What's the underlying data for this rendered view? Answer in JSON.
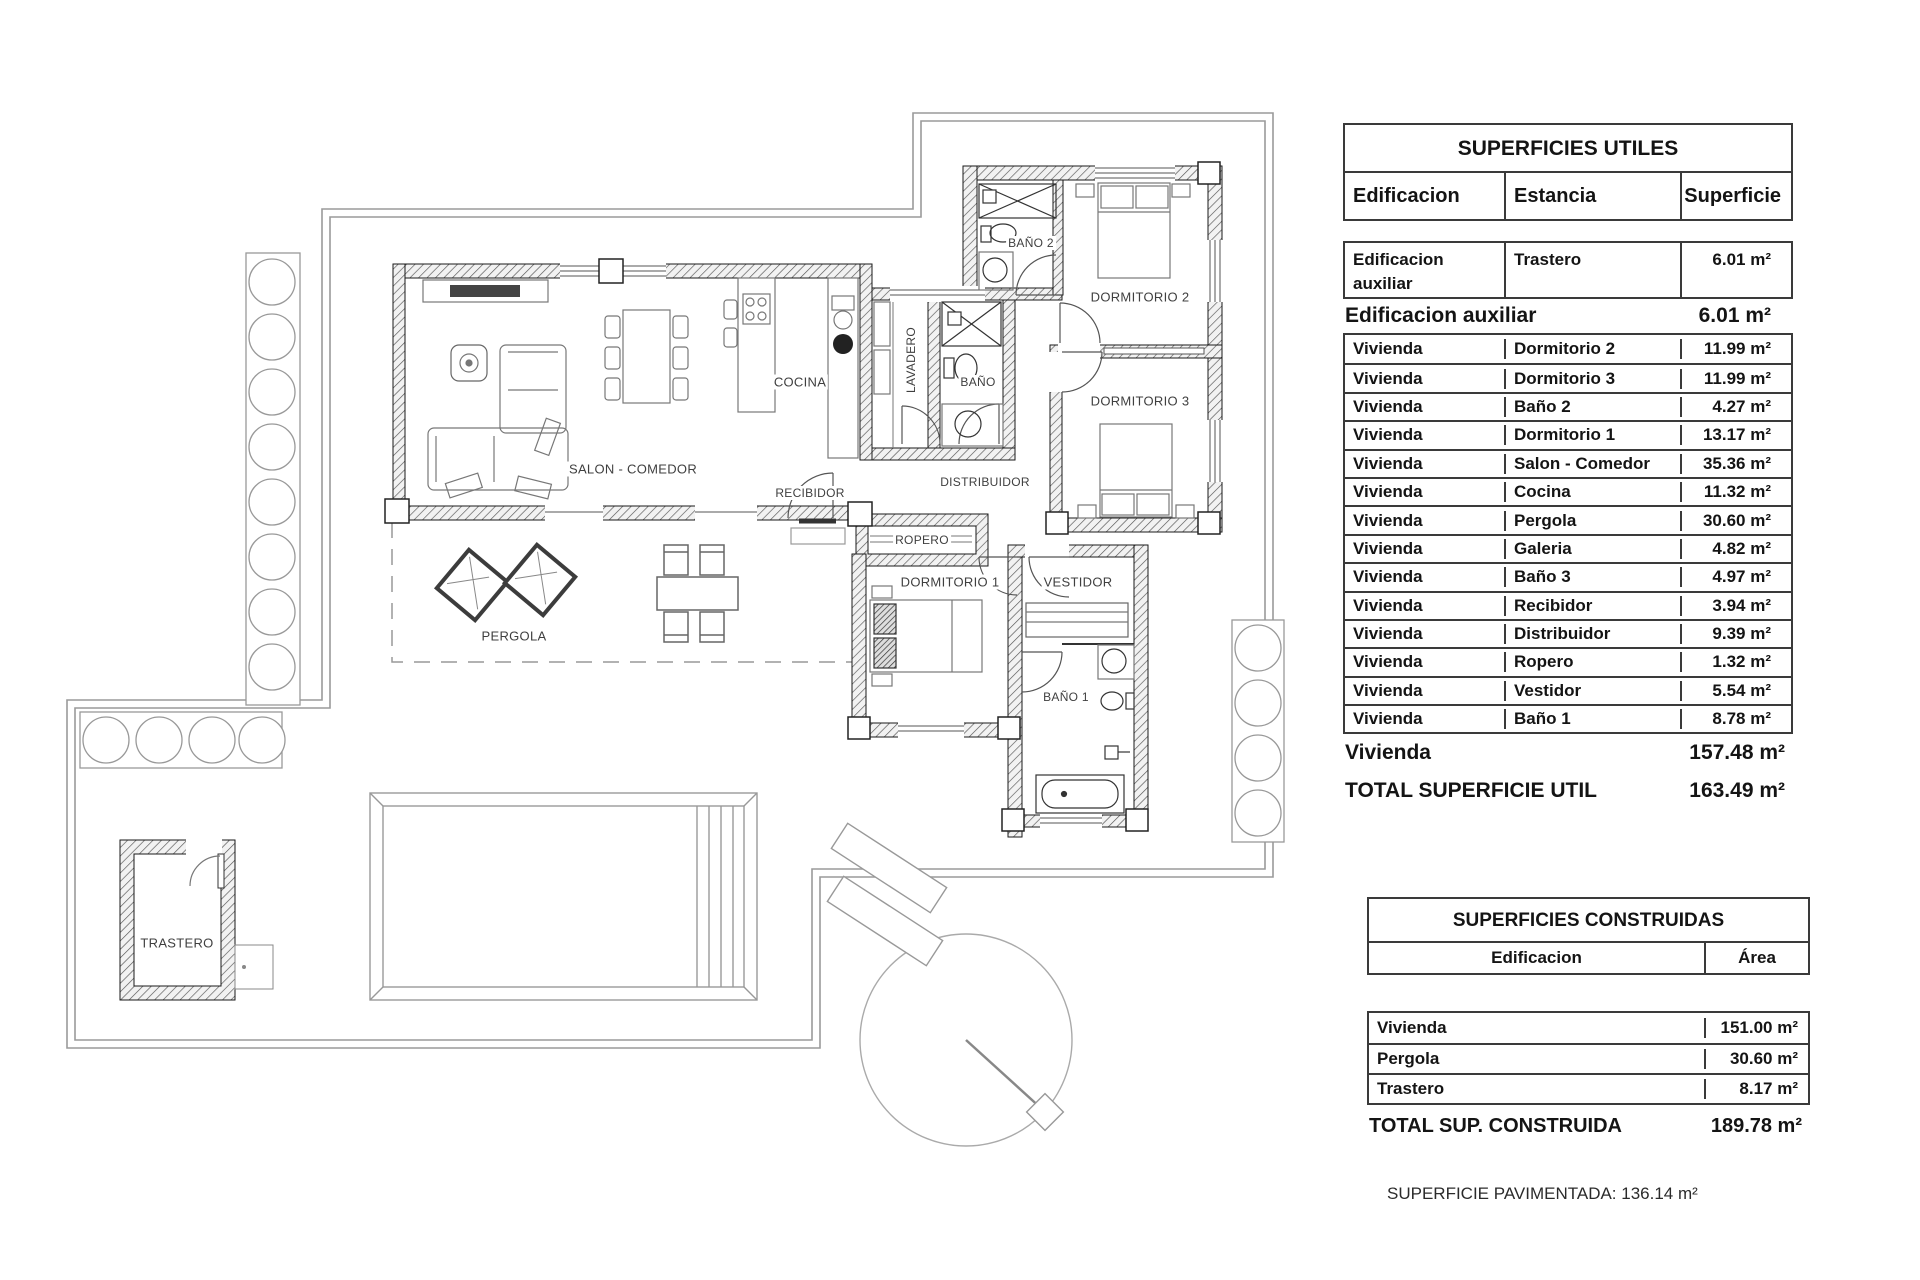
{
  "floorplan": {
    "rooms": [
      {
        "label": "BAÑO 2"
      },
      {
        "label": "DORMITORIO 2"
      },
      {
        "label": "LAVADERO"
      },
      {
        "label": "BAÑO"
      },
      {
        "label": "COCINA"
      },
      {
        "label": "DORMITORIO 3"
      },
      {
        "label": "SALON - COMEDOR"
      },
      {
        "label": "RECIBIDOR"
      },
      {
        "label": "DISTRIBUIDOR"
      },
      {
        "label": "ROPERO"
      },
      {
        "label": "DORMITORIO 1"
      },
      {
        "label": "VESTIDOR"
      },
      {
        "label": "PERGOLA"
      },
      {
        "label": "BAÑO 1"
      },
      {
        "label": "TRASTERO"
      }
    ]
  },
  "superficies_utiles": {
    "title": "SUPERFICIES UTILES",
    "headers": {
      "edificacion": "Edificacion",
      "estancia": "Estancia",
      "superficie": "Superficie"
    },
    "aux_row": {
      "edificacion": "Edificacion auxiliar",
      "estancia": "Trastero",
      "superficie": "6.01 m²"
    },
    "aux_summary": {
      "label": "Edificacion auxiliar",
      "value": "6.01 m²"
    },
    "rows": [
      {
        "edificacion": "Vivienda",
        "estancia": "Dormitorio 2",
        "superficie": "11.99 m²"
      },
      {
        "edificacion": "Vivienda",
        "estancia": "Dormitorio 3",
        "superficie": "11.99 m²"
      },
      {
        "edificacion": "Vivienda",
        "estancia": "Baño 2",
        "superficie": "4.27 m²"
      },
      {
        "edificacion": "Vivienda",
        "estancia": "Dormitorio 1",
        "superficie": "13.17 m²"
      },
      {
        "edificacion": "Vivienda",
        "estancia": "Salon - Comedor",
        "superficie": "35.36 m²"
      },
      {
        "edificacion": "Vivienda",
        "estancia": "Cocina",
        "superficie": "11.32 m²"
      },
      {
        "edificacion": "Vivienda",
        "estancia": "Pergola",
        "superficie": "30.60 m²"
      },
      {
        "edificacion": "Vivienda",
        "estancia": "Galeria",
        "superficie": "4.82 m²"
      },
      {
        "edificacion": "Vivienda",
        "estancia": "Baño 3",
        "superficie": "4.97 m²"
      },
      {
        "edificacion": "Vivienda",
        "estancia": "Recibidor",
        "superficie": "3.94 m²"
      },
      {
        "edificacion": "Vivienda",
        "estancia": "Distribuidor",
        "superficie": "9.39 m²"
      },
      {
        "edificacion": "Vivienda",
        "estancia": "Ropero",
        "superficie": "1.32 m²"
      },
      {
        "edificacion": "Vivienda",
        "estancia": "Vestidor",
        "superficie": "5.54 m²"
      },
      {
        "edificacion": "Vivienda",
        "estancia": "Baño 1",
        "superficie": "8.78 m²"
      }
    ],
    "vivienda_summary": {
      "label": "Vivienda",
      "value": "157.48 m²"
    },
    "total": {
      "label": "TOTAL SUPERFICIE UTIL",
      "value": "163.49 m²"
    }
  },
  "superficies_construidas": {
    "title": "SUPERFICIES CONSTRUIDAS",
    "headers": {
      "edificacion": "Edificacion",
      "area": "Área"
    },
    "rows": [
      {
        "edificacion": "Vivienda",
        "area": "151.00 m²"
      },
      {
        "edificacion": "Pergola",
        "area": "30.60 m²"
      },
      {
        "edificacion": "Trastero",
        "area": "8.17 m²"
      }
    ],
    "total": {
      "label": "TOTAL SUP. CONSTRUIDA",
      "value": "189.78 m²"
    }
  },
  "footer": {
    "pavimentada": "SUPERFICIE PAVIMENTADA: 136.14 m²"
  }
}
